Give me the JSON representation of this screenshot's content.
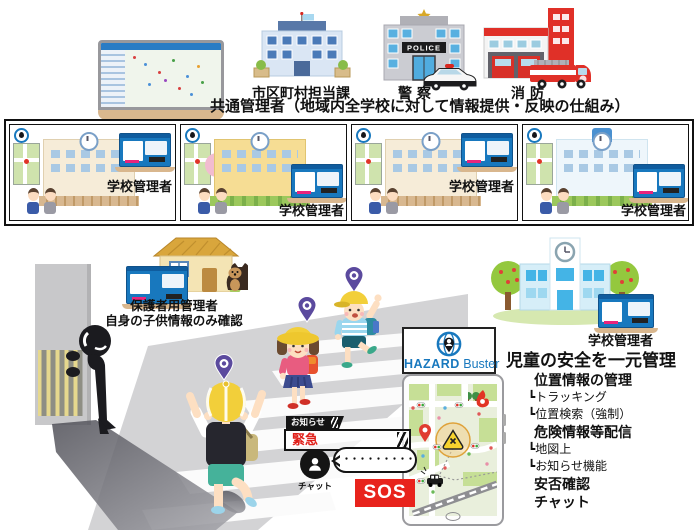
{
  "top": {
    "caption": "共通管理者（地域内全学校に対して情報提供・反映の仕組み）",
    "buildings": [
      {
        "label": "市区町村担当課"
      },
      {
        "label": "警察",
        "sign": "POLICE"
      },
      {
        "label": "消防"
      }
    ]
  },
  "school_row": {
    "panels": [
      {
        "label": "学校管理者"
      },
      {
        "label": "学校管理者"
      },
      {
        "label": "学校管理者"
      },
      {
        "label": "学校管理者"
      }
    ]
  },
  "parent_admin": {
    "line1": "保護者用管理者",
    "line2": "自身の子供情報のみ確認"
  },
  "right_school": {
    "label": "学校管理者"
  },
  "logo": {
    "bold": "HAZARD",
    "regular": "Buster"
  },
  "alerts": {
    "notice_tag": "お知らせ",
    "emergency": "緊急",
    "chat_label": "チャット",
    "chat_dots": "・・・・・・・・・・・・・・",
    "sos": "SOS"
  },
  "features": {
    "title": "児童の安全を一元管理",
    "items": [
      "位置情報の管理",
      "┗トラッキング",
      "┗位置検索（強制）",
      "危険情報等配信",
      "┗地図上",
      "┗お知らせ機能",
      "安否確認",
      "チャット"
    ]
  },
  "colors": {
    "brand_blue": "#1878be",
    "alert_red": "#e8231c",
    "pin_purple": "#5b4a9e",
    "hat_yellow": "#f2cf3a"
  }
}
